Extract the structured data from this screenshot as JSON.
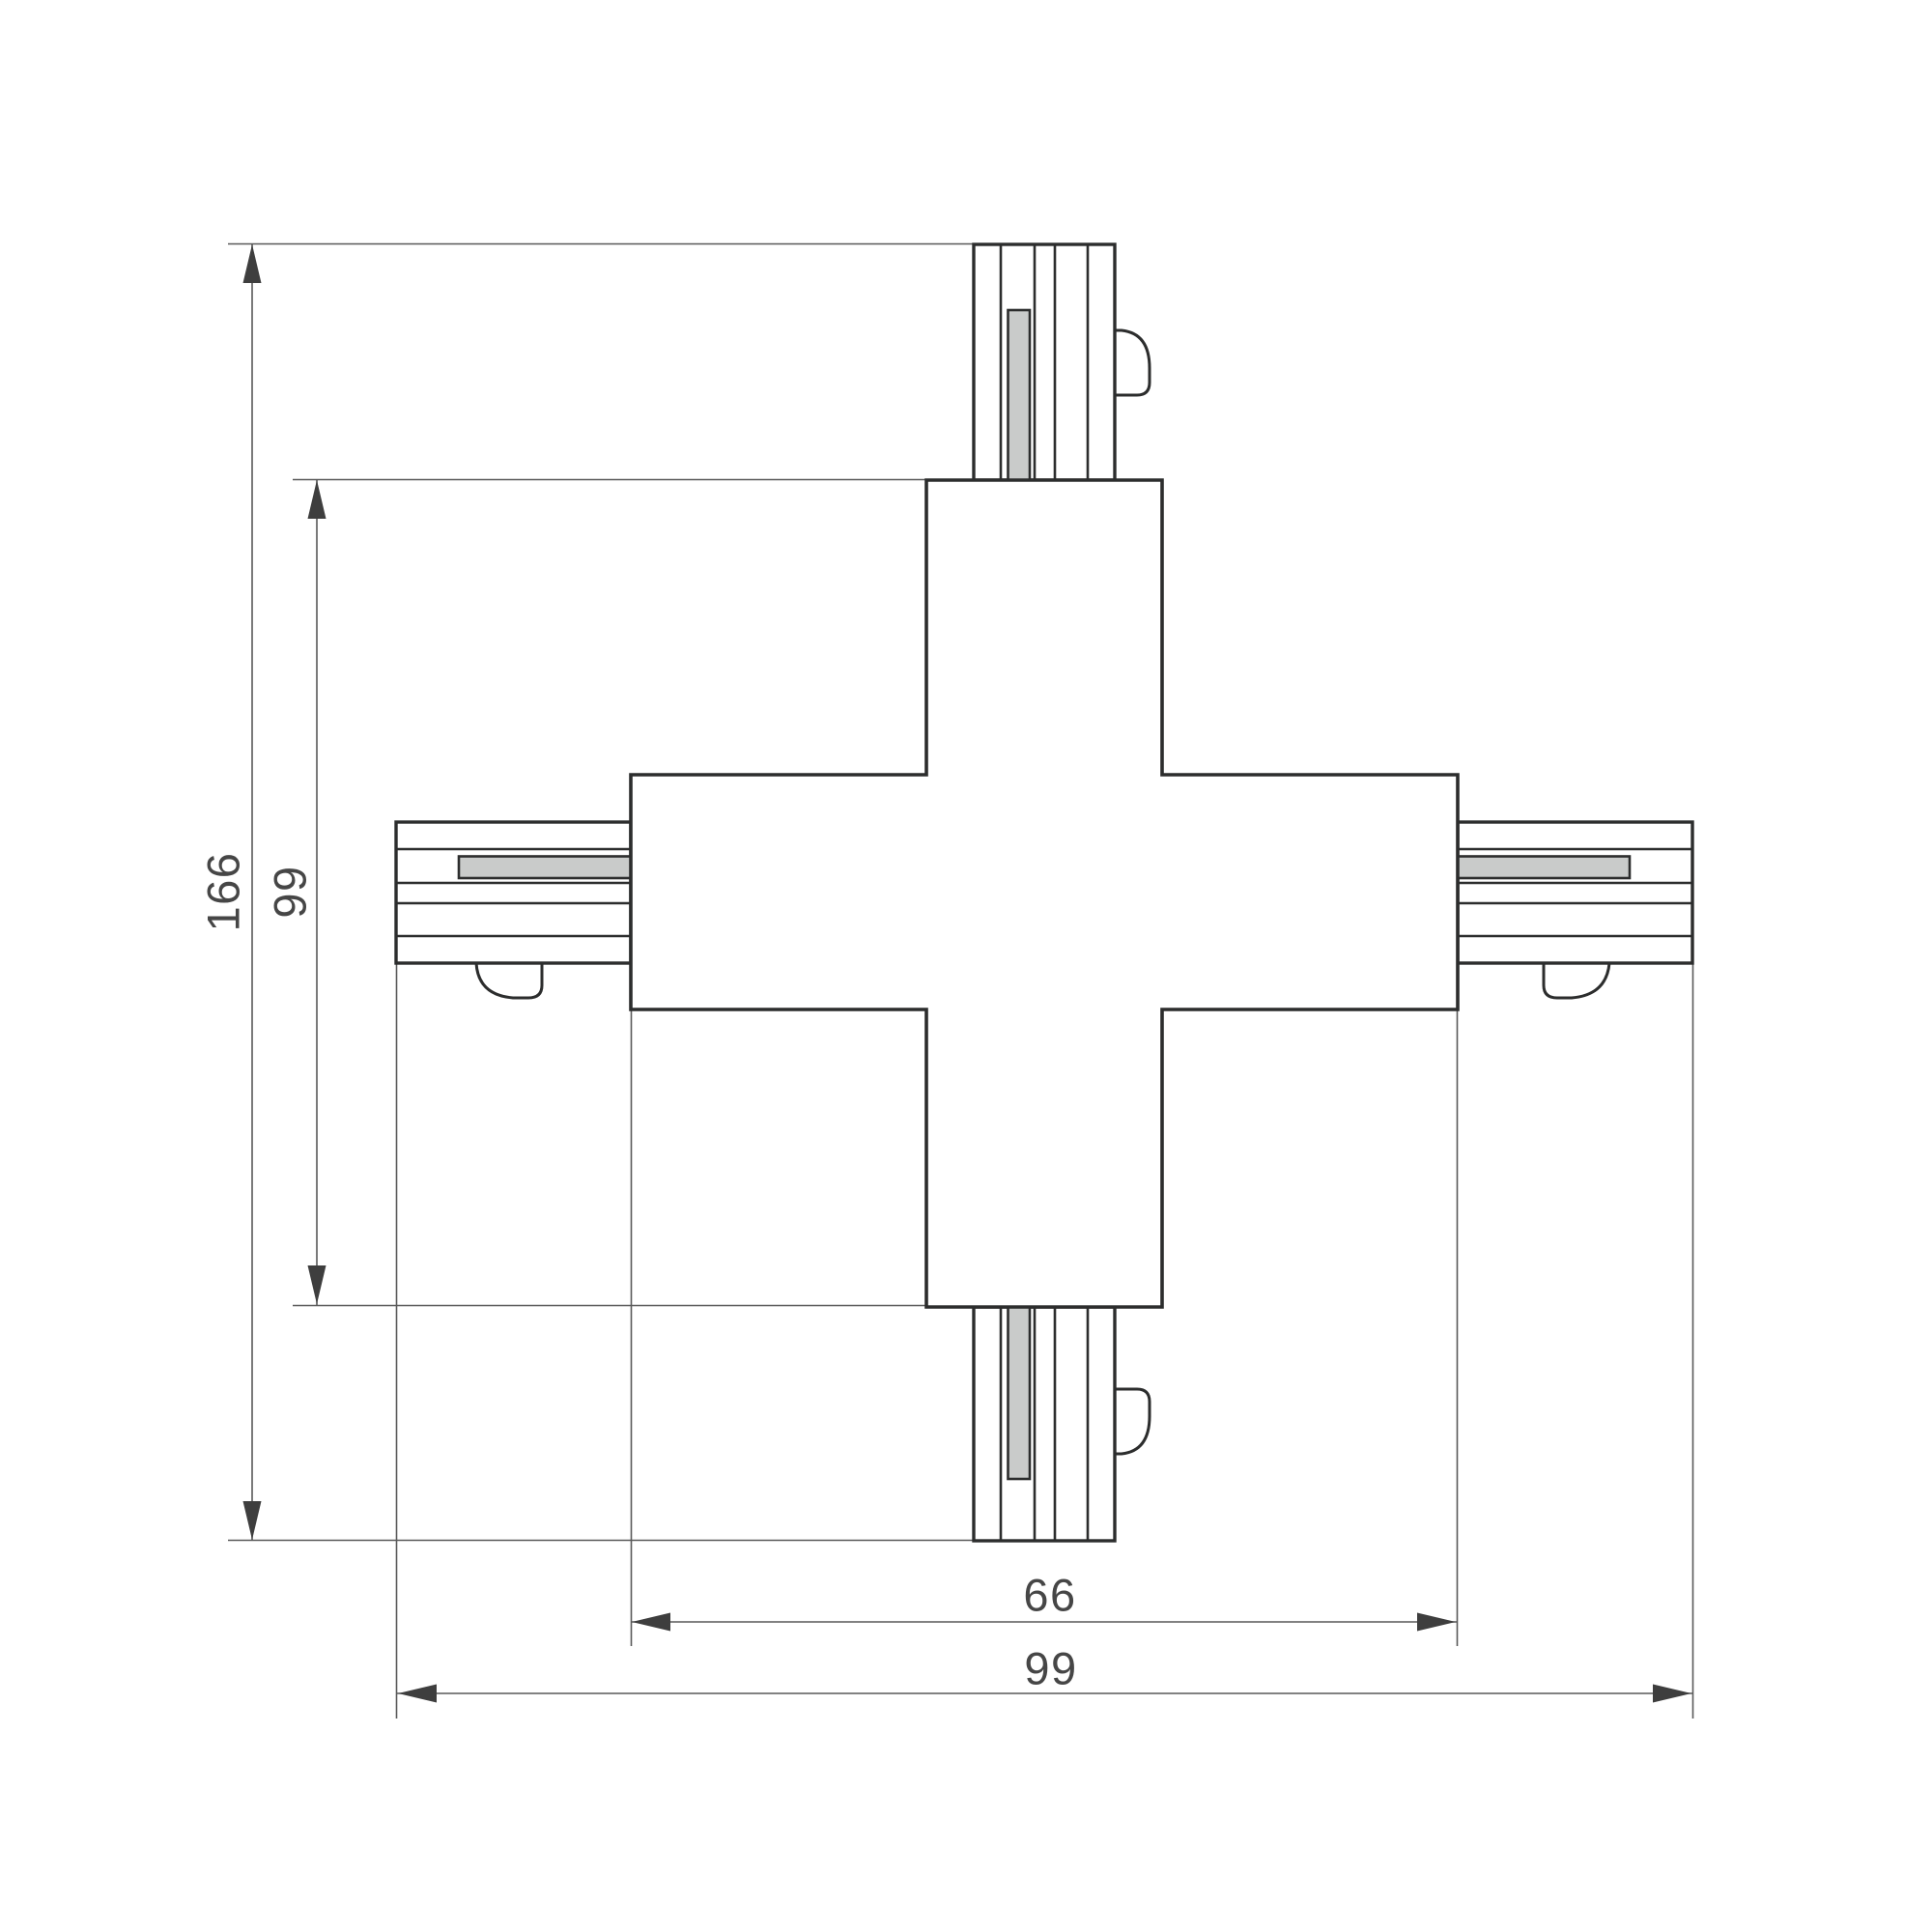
{
  "drawing": {
    "title": "4-way X-shaped track connector — dimensional drawing (top view)",
    "dimensions": {
      "overall_vertical": "166",
      "body_vertical": "99",
      "body_horizontal": "66",
      "overall_horizontal": "99"
    },
    "colors": {
      "outline": "#2c2d2d",
      "thin_line": "#595959",
      "arrow_fill": "#3e3e3e",
      "label_text": "#464646",
      "conductor_fill": "#c9cbca",
      "background": "#ffffff"
    }
  }
}
